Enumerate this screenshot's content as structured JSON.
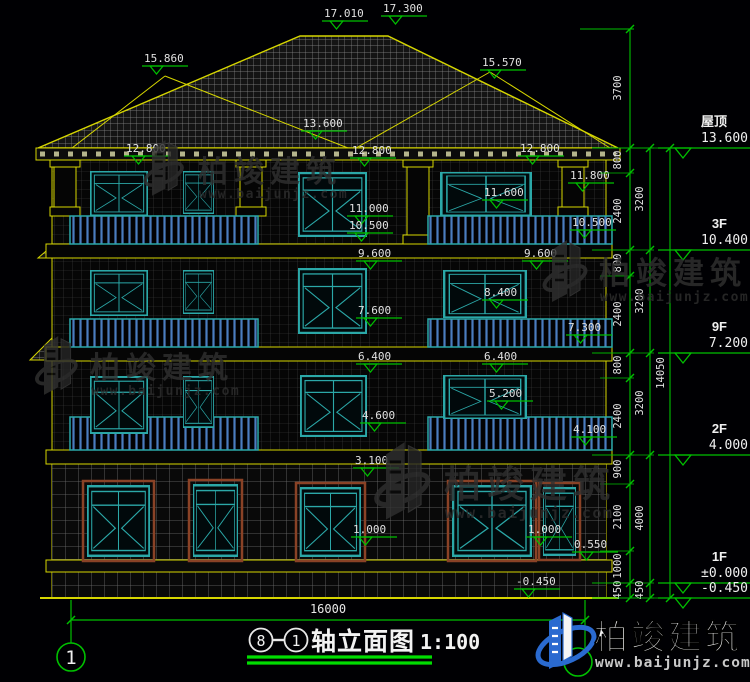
{
  "drawing": {
    "type": "building-elevation-cad",
    "colors": {
      "background": "#000003",
      "outline_yellow": "#d6d600",
      "dimension_green": "#00c000",
      "window_teal": "#2ba8a8",
      "railing_blue": "#4a7cc0",
      "text_white": "#e8e8e8",
      "surround_brown": "#8a4226",
      "watermark_gray": "#303030",
      "logo_blue": "#2a6ad0",
      "title_underline_green": "#00dd00"
    }
  },
  "elevation_markers": [
    {
      "t": "17.010",
      "x": 324,
      "y": 17
    },
    {
      "t": "17.300",
      "x": 383,
      "y": 12
    },
    {
      "t": "15.860",
      "x": 144,
      "y": 62
    },
    {
      "t": "15.570",
      "x": 482,
      "y": 66
    },
    {
      "t": "13.600",
      "x": 303,
      "y": 127
    },
    {
      "t": "12.800",
      "x": 126,
      "y": 152
    },
    {
      "t": "12.800",
      "x": 352,
      "y": 154
    },
    {
      "t": "12.800",
      "x": 520,
      "y": 152
    },
    {
      "t": "11.800",
      "x": 570,
      "y": 179
    },
    {
      "t": "11.600",
      "x": 484,
      "y": 196
    },
    {
      "t": "11.000",
      "x": 349,
      "y": 212
    },
    {
      "t": "10.500",
      "x": 349,
      "y": 229
    },
    {
      "t": "10.500",
      "x": 572,
      "y": 226
    },
    {
      "t": "9.600",
      "x": 358,
      "y": 257
    },
    {
      "t": "9.600",
      "x": 524,
      "y": 257
    },
    {
      "t": "8.400",
      "x": 484,
      "y": 296
    },
    {
      "t": "7.600",
      "x": 358,
      "y": 314
    },
    {
      "t": "7.300",
      "x": 568,
      "y": 331
    },
    {
      "t": "6.400",
      "x": 358,
      "y": 360
    },
    {
      "t": "6.400",
      "x": 484,
      "y": 360
    },
    {
      "t": "5.200",
      "x": 489,
      "y": 397
    },
    {
      "t": "4.600",
      "x": 362,
      "y": 419
    },
    {
      "t": "4.100",
      "x": 573,
      "y": 433
    },
    {
      "t": "3.100",
      "x": 355,
      "y": 464
    },
    {
      "t": "1.000",
      "x": 353,
      "y": 533
    },
    {
      "t": "1.000",
      "x": 528,
      "y": 533
    },
    {
      "t": "0.550",
      "x": 574,
      "y": 548
    },
    {
      "t": "-0.450",
      "x": 516,
      "y": 585
    }
  ],
  "dim_chains": [
    {
      "x": 621,
      "line_x": 630,
      "top": 29,
      "bottom": 598,
      "labels": [
        {
          "t": "3700",
          "y": 88
        },
        {
          "t": "800",
          "y": 160
        },
        {
          "t": "2400",
          "y": 211
        },
        {
          "t": "800",
          "y": 263
        },
        {
          "t": "2400",
          "y": 314
        },
        {
          "t": "800",
          "y": 365
        },
        {
          "t": "2400",
          "y": 416
        },
        {
          "t": "900",
          "y": 469
        },
        {
          "t": "2100",
          "y": 517
        },
        {
          "t": "1000",
          "y": 566
        },
        {
          "t": "450",
          "y": 590
        }
      ],
      "ticks": [
        29,
        148,
        173,
        250,
        276,
        353,
        378,
        455,
        484,
        551,
        583,
        598
      ]
    },
    {
      "x": 643,
      "line_x": 650,
      "top": 148,
      "bottom": 598,
      "labels": [
        {
          "t": "3200",
          "y": 199
        },
        {
          "t": "3200",
          "y": 301
        },
        {
          "t": "3200",
          "y": 403
        },
        {
          "t": "4000",
          "y": 518
        },
        {
          "t": "450",
          "y": 590
        }
      ],
      "ticks": [
        148,
        250,
        353,
        455,
        583,
        598
      ]
    },
    {
      "x": 664,
      "line_x": 670,
      "top": 148,
      "bottom": 598,
      "labels": [
        {
          "t": "14050",
          "y": 373
        }
      ],
      "ticks": [
        148,
        598
      ]
    }
  ],
  "levels": [
    {
      "name": "屋顶",
      "elev": "13.600",
      "y": 148
    },
    {
      "name": "3F",
      "elev": "10.400",
      "y": 250
    },
    {
      "name": "9F",
      "elev": "7.200",
      "y": 353
    },
    {
      "name": "2F",
      "elev": "4.000",
      "y": 455
    },
    {
      "name": "1F",
      "elev": "±0.000",
      "y": 583
    },
    {
      "name": "",
      "elev": "-0.450",
      "y": 598
    }
  ],
  "bottom": {
    "overall_dim": "16000",
    "axis_bubble_left": "1",
    "title_axis_a": "8",
    "title_axis_b": "1",
    "title": "轴立面图",
    "scale": "1:100"
  },
  "watermarks": [
    {
      "x": 152,
      "y": 140,
      "s": 0.9,
      "text": "柏竣建筑",
      "url": "www.baijunjz.com",
      "tx": 46,
      "ty": 42,
      "ux": 47,
      "uy": 58,
      "fs": 30,
      "us": 13
    },
    {
      "x": 552,
      "y": 240,
      "s": 1.0,
      "text": "柏竣建筑",
      "url": "www.baijunjz.com",
      "tx": 47,
      "ty": 44,
      "ux": 48,
      "uy": 61,
      "fs": 31,
      "us": 13
    },
    {
      "x": 44,
      "y": 336,
      "s": 0.95,
      "text": "柏竣建筑",
      "url": "www.baijunjz.com",
      "tx": 46,
      "ty": 42,
      "ux": 47,
      "uy": 59,
      "fs": 30,
      "us": 13
    },
    {
      "x": 386,
      "y": 442,
      "s": 1.25,
      "text": "柏竣建筑",
      "url": "www.baijunjz.com",
      "tx": 58,
      "ty": 55,
      "ux": 59,
      "uy": 76,
      "fs": 37,
      "us": 15
    }
  ],
  "logo": {
    "text": "柏竣建筑",
    "url": "www.baijunjz.com"
  }
}
